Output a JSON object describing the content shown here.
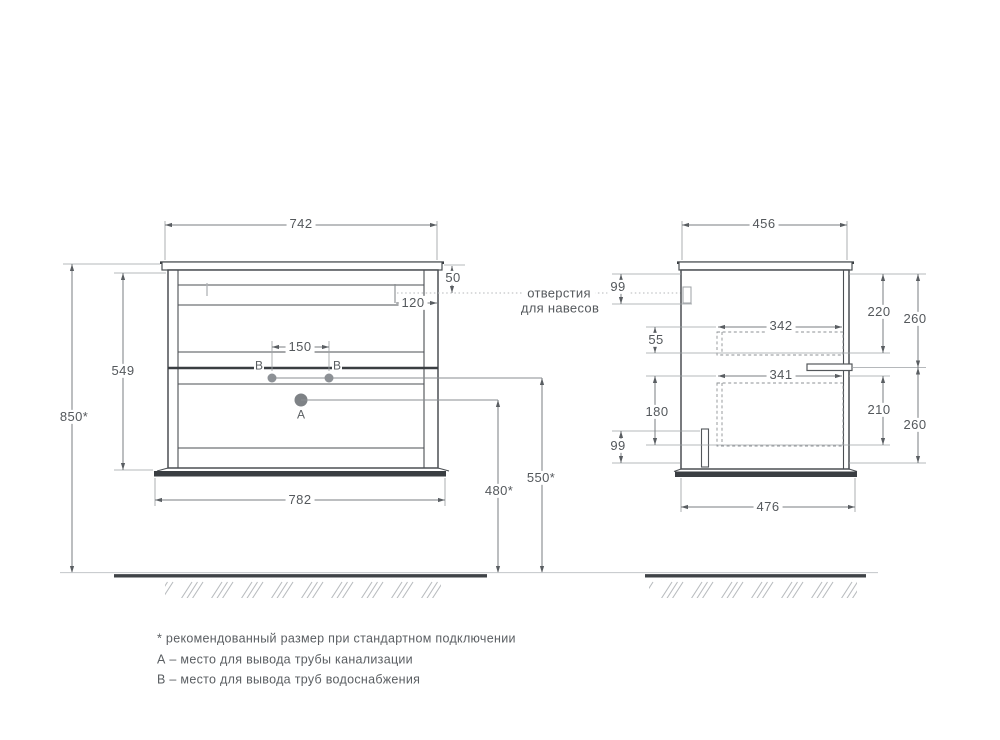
{
  "front_view": {
    "width_top": "742",
    "hole_top_offset": "50",
    "hole_side_offset": "120",
    "supply_spacing": "150",
    "body_height": "549",
    "mount_height": "850*",
    "drain_outlet_height": "480*",
    "supply_outlet_height": "550*",
    "width_bottom": "782",
    "label_a": "А",
    "label_b_left": "В",
    "label_b_right": "В"
  },
  "side_view": {
    "depth_top": "456",
    "hanger_offset": "99",
    "top_drawer_depth": "342",
    "top_gap": "55",
    "bottom_drawer_depth": "341",
    "side_slot_height": "180",
    "side_slot_offset": "99",
    "depth_bottom": "476",
    "top_drawer_inner_height": "220",
    "top_section_height": "260",
    "bottom_drawer_inner_height": "210",
    "bottom_section_height": "260"
  },
  "callout": {
    "line1": "отверстия",
    "line2": "для навесов"
  },
  "notes": {
    "asterisk": "* рекомендованный размер при стандартном подключении",
    "a": "А – место для вывода трубы канализации",
    "b": "В – место для вывода труб водоснабжения"
  },
  "colors": {
    "outline": "#43474b",
    "dimension": "#7a7e82",
    "text": "#55595d",
    "ground": "#3f4347"
  }
}
